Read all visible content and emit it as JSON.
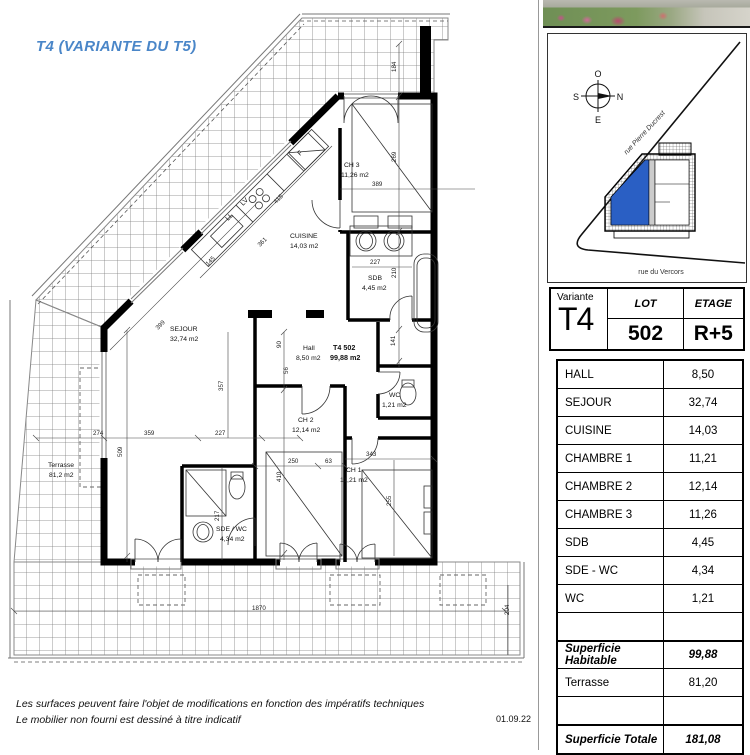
{
  "title": "T4 (VARIANTE DU T5)",
  "colors": {
    "accent_blue": "#4a86c8",
    "unit_blue": "#2a5fc4"
  },
  "header_table": {
    "variante_label": "Variante",
    "variante_value": "T4",
    "lot_label": "LOT",
    "lot_value": "502",
    "etage_label": "ETAGE",
    "etage_value": "R+5"
  },
  "rooms_table": {
    "rows": [
      {
        "label": "HALL",
        "value": "8,50",
        "cls": ""
      },
      {
        "label": "SEJOUR",
        "value": "32,74",
        "cls": ""
      },
      {
        "label": "CUISINE",
        "value": "14,03",
        "cls": ""
      },
      {
        "label": "CHAMBRE 1",
        "value": "11,21",
        "cls": ""
      },
      {
        "label": "CHAMBRE 2",
        "value": "12,14",
        "cls": ""
      },
      {
        "label": "CHAMBRE 3",
        "value": "11,26",
        "cls": ""
      },
      {
        "label": "SDB",
        "value": "4,45",
        "cls": ""
      },
      {
        "label": "SDE - WC",
        "value": "4,34",
        "cls": ""
      },
      {
        "label": "WC",
        "value": "1,21",
        "cls": ""
      },
      {
        "label": "",
        "value": "",
        "cls": ""
      },
      {
        "label": "Superficie Habitable",
        "value": "99,88",
        "cls": "bold thick"
      },
      {
        "label": "Terrasse",
        "value": "81,20",
        "cls": ""
      },
      {
        "label": "",
        "value": "",
        "cls": ""
      },
      {
        "label": "Superficie Totale",
        "value": "181,08",
        "cls": "bold thick"
      }
    ]
  },
  "site": {
    "compass": {
      "top": "O",
      "left": "S",
      "right": "N",
      "bottom": "E"
    },
    "street_diagonal": "rue Pierre Ducrest",
    "street_bottom": "rue du Vercors"
  },
  "footer": {
    "line1": "Les surfaces peuvent faire l'objet de modifications en fonction des impératifs techniques",
    "line2": "Le mobilier non fourni est dessiné à titre indicatif",
    "date": "01.09.22"
  },
  "plan": {
    "labels": [
      {
        "t": "SEJOUR",
        "x": 170,
        "y": 331
      },
      {
        "t": "32,74 m2",
        "x": 170,
        "y": 341
      },
      {
        "t": "CUISINE",
        "x": 290,
        "y": 238
      },
      {
        "t": "14,03 m2",
        "x": 290,
        "y": 248
      },
      {
        "t": "CH 3",
        "x": 344,
        "y": 167
      },
      {
        "t": "11,26 m2",
        "x": 341,
        "y": 177
      },
      {
        "t": "SDB",
        "x": 368,
        "y": 280
      },
      {
        "t": "4,45 m2",
        "x": 362,
        "y": 290
      },
      {
        "t": "Hall",
        "x": 303,
        "y": 350
      },
      {
        "t": "8,50 m2",
        "x": 296,
        "y": 360
      },
      {
        "t": "T4 502",
        "x": 333,
        "y": 350,
        "b": 1
      },
      {
        "t": "99,88 m2",
        "x": 330,
        "y": 360,
        "b": 1
      },
      {
        "t": "WC",
        "x": 389,
        "y": 397
      },
      {
        "t": "1,21 m2",
        "x": 382,
        "y": 407
      },
      {
        "t": "CH 2",
        "x": 298,
        "y": 422
      },
      {
        "t": "12,14 m2",
        "x": 292,
        "y": 432
      },
      {
        "t": "CH 1",
        "x": 346,
        "y": 472
      },
      {
        "t": "11,21 m2",
        "x": 340,
        "y": 482
      },
      {
        "t": "SDE / WC",
        "x": 216,
        "y": 531
      },
      {
        "t": "4,34 m2",
        "x": 220,
        "y": 541
      },
      {
        "t": "Terrasse",
        "x": 48,
        "y": 467
      },
      {
        "t": "81,2 m2",
        "x": 49,
        "y": 477
      },
      {
        "t": "F",
        "x": 300,
        "y": 156,
        "r": -45
      },
      {
        "t": "LV",
        "x": 243,
        "y": 206,
        "r": -45
      },
      {
        "t": "LL",
        "x": 228,
        "y": 221,
        "r": -45
      }
    ],
    "dims": [
      {
        "t": "184",
        "x": 396,
        "y": 72,
        "r": -90
      },
      {
        "t": "269",
        "x": 396,
        "y": 162,
        "r": -90
      },
      {
        "t": "389",
        "x": 372,
        "y": 186
      },
      {
        "t": "227",
        "x": 370,
        "y": 264
      },
      {
        "t": "210",
        "x": 396,
        "y": 278,
        "r": -90
      },
      {
        "t": "141",
        "x": 395,
        "y": 346,
        "r": -90
      },
      {
        "t": "90",
        "x": 281,
        "y": 348,
        "r": -90
      },
      {
        "t": "56",
        "x": 288,
        "y": 374,
        "r": -90
      },
      {
        "t": "250",
        "x": 288,
        "y": 463
      },
      {
        "t": "63",
        "x": 325,
        "y": 463
      },
      {
        "t": "343",
        "x": 366,
        "y": 456
      },
      {
        "t": "410",
        "x": 281,
        "y": 482,
        "r": -90
      },
      {
        "t": "217",
        "x": 219,
        "y": 521,
        "r": -90
      },
      {
        "t": "255",
        "x": 391,
        "y": 506,
        "r": -90
      },
      {
        "t": "274",
        "x": 93,
        "y": 435
      },
      {
        "t": "359",
        "x": 144,
        "y": 435
      },
      {
        "t": "227",
        "x": 215,
        "y": 435
      },
      {
        "t": "509",
        "x": 122,
        "y": 457,
        "r": -90
      },
      {
        "t": "357",
        "x": 223,
        "y": 391,
        "r": -90
      },
      {
        "t": "399",
        "x": 158,
        "y": 330,
        "r": -45
      },
      {
        "t": "415",
        "x": 276,
        "y": 204,
        "r": -45
      },
      {
        "t": "361",
        "x": 260,
        "y": 247,
        "r": -45
      },
      {
        "t": "145",
        "x": 208,
        "y": 266,
        "r": -45
      },
      {
        "t": "1870",
        "x": 252,
        "y": 610
      },
      {
        "t": "204",
        "x": 509,
        "y": 615,
        "r": -90
      }
    ]
  }
}
